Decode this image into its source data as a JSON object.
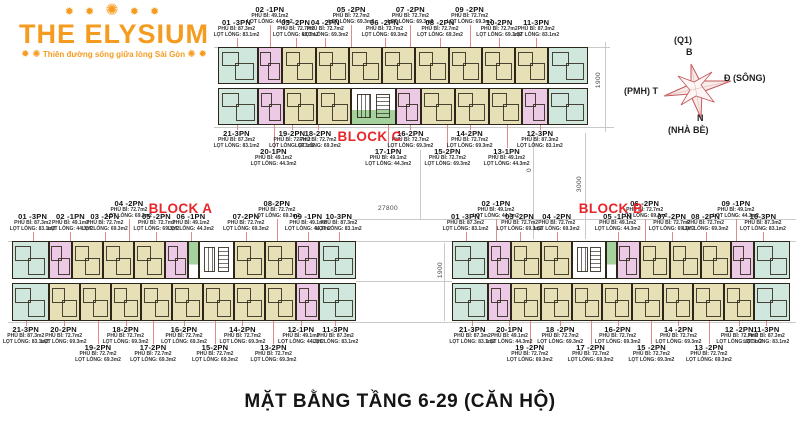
{
  "logo": {
    "stars_l": "✹ ✹",
    "star_mid": "✺",
    "stars_r": "✹ ✹",
    "title": "THE ELYSIUM",
    "tag_l": "✹ ✺",
    "tagline": "Thiên đường sống giữa lòng Sài Gòn",
    "tag_r": "✺ ✹",
    "color": "#f59b20"
  },
  "compass": {
    "q1": "(Q1)",
    "b": "B",
    "e": "Đ (SÔNG)",
    "w": "(PMH) T",
    "n": "N",
    "nb": "(NHÀ BÈ)",
    "color": "#c4565a"
  },
  "dims": {
    "d27800": "27800",
    "d1900c": "1900",
    "d1900b": "1900",
    "d0": "0",
    "d3000": "3000"
  },
  "title": "MẶT BẰNG TẦNG 6-29 (CĂN HỘ)",
  "palette": {
    "3PN": "#cfe7dd",
    "1PN": "#ecc9e5",
    "2PN": "#e7e0b6",
    "lobby": "#a5d29c",
    "wall": "#2b2619",
    "leader": "#e08a8a",
    "block_label": "#e8262a"
  },
  "areas": {
    "3PN": [
      "PHỦ BÌ: 87.3m2",
      "LỌT LÒNG: 83.1m2"
    ],
    "2PN": [
      "PHỦ BÌ: 72.7m2",
      "LỌT LÒNG: 69.3m2"
    ],
    "1PN": [
      "PHỦ BÌ: 49.1m2",
      "LỌT LÒNG: 44.3m2"
    ]
  },
  "blocks": [
    {
      "id": "c",
      "name": "BLOCK C",
      "geom": {
        "left": 218,
        "top": 6,
        "width": 370,
        "top_zone": 41,
        "strip_h": 37,
        "gap": 4,
        "bottom_zone": 64
      },
      "block_label": {
        "zone": "bottom",
        "x": 41
      },
      "units_top": [
        "3PN",
        "1PN",
        "2PN",
        "2PN",
        "2PN",
        "2PN",
        "2PN",
        "2PN",
        "2PN",
        "2PN",
        "3PN"
      ],
      "units_bottom": [
        "3PN",
        "1PN",
        "2PN",
        "2PN",
        "coreB",
        "1PN",
        "2PN",
        "2PN",
        "2PN",
        "1PN",
        "3PN"
      ],
      "labels_top": [
        {
          "id": "01 -3PN",
          "t": "3PN",
          "x": 5,
          "row": 2
        },
        {
          "id": "02 -1PN",
          "t": "1PN",
          "x": 14,
          "row": 1
        },
        {
          "id": "03 -2PN",
          "t": "2PN",
          "x": 21,
          "row": 2
        },
        {
          "id": "04 -2PN",
          "t": "2PN",
          "x": 29,
          "row": 2
        },
        {
          "id": "05 -2PN",
          "t": "2PN",
          "x": 36,
          "row": 1
        },
        {
          "id": "06 -2PN",
          "t": "2PN",
          "x": 45,
          "row": 2
        },
        {
          "id": "07 -2PN",
          "t": "2PN",
          "x": 52,
          "row": 1
        },
        {
          "id": "08 -2PN",
          "t": "2PN",
          "x": 60,
          "row": 2
        },
        {
          "id": "09 -2PN",
          "t": "2PN",
          "x": 68,
          "row": 1
        },
        {
          "id": "10-2PN",
          "t": "2PN",
          "x": 76,
          "row": 2
        },
        {
          "id": "11-3PN",
          "t": "3PN",
          "x": 86,
          "row": 2
        }
      ],
      "labels_bottom": [
        {
          "id": "21-3PN",
          "t": "3PN",
          "x": 5,
          "row": 1
        },
        {
          "id": "20-1PN",
          "t": "1PN",
          "x": 15,
          "row": 2
        },
        {
          "id": "19-2PN",
          "t": "2PN",
          "x": 20,
          "row": 1
        },
        {
          "id": "18-2PN",
          "t": "2PN",
          "x": 27,
          "row": 1
        },
        {
          "id": "17-1PN",
          "t": "1PN",
          "x": 46,
          "row": 2
        },
        {
          "id": "16-2PN",
          "t": "2PN",
          "x": 52,
          "row": 1
        },
        {
          "id": "15-2PN",
          "t": "2PN",
          "x": 62,
          "row": 2
        },
        {
          "id": "14-2PN",
          "t": "2PN",
          "x": 68,
          "row": 1
        },
        {
          "id": "13-1PN",
          "t": "1PN",
          "x": 78,
          "row": 2
        },
        {
          "id": "12-3PN",
          "t": "3PN",
          "x": 87,
          "row": 1
        }
      ]
    },
    {
      "id": "a",
      "name": "BLOCK A",
      "geom": {
        "left": 12,
        "top": 200,
        "width": 344,
        "top_zone": 41,
        "strip_h": 38,
        "gap": 4,
        "bottom_zone": 70
      },
      "block_label": {
        "zone": "top",
        "x": 49
      },
      "units_top": [
        "3PN",
        "1PN",
        "2PN",
        "2PN",
        "2PN",
        "1PN",
        "lobby",
        "core",
        "2PN",
        "2PN",
        "1PN",
        "3PN"
      ],
      "units_bottom": [
        "3PN",
        "2PN",
        "2PN",
        "2PN",
        "2PN",
        "2PN",
        "2PN",
        "2PN",
        "2PN",
        "1PN",
        "3PN"
      ],
      "labels_top": [
        {
          "id": "01 -3PN",
          "t": "3PN",
          "x": 6,
          "row": 2
        },
        {
          "id": "02 -1PN",
          "t": "1PN",
          "x": 17,
          "row": 2
        },
        {
          "id": "03 -2PN",
          "t": "2PN",
          "x": 27,
          "row": 2
        },
        {
          "id": "04 -2PN",
          "t": "2PN",
          "x": 34,
          "row": 1
        },
        {
          "id": "05 -2PN",
          "t": "2PN",
          "x": 42,
          "row": 2
        },
        {
          "id": "06 -1PN",
          "t": "1PN",
          "x": 52,
          "row": 2
        },
        {
          "id": "07-2PN",
          "t": "2PN",
          "x": 68,
          "row": 2
        },
        {
          "id": "08-2PN",
          "t": "2PN",
          "x": 77,
          "row": 1
        },
        {
          "id": "09 -1PN",
          "t": "1PN",
          "x": 86,
          "row": 2
        },
        {
          "id": "10-3PN",
          "t": "3PN",
          "x": 95,
          "row": 2
        }
      ],
      "labels_bottom": [
        {
          "id": "21-3PN",
          "t": "3PN",
          "x": 4,
          "row": 1
        },
        {
          "id": "20-2PN",
          "t": "2PN",
          "x": 15,
          "row": 1
        },
        {
          "id": "19-2PN",
          "t": "2PN",
          "x": 25,
          "row": 2
        },
        {
          "id": "18-2PN",
          "t": "2PN",
          "x": 33,
          "row": 1
        },
        {
          "id": "17-2PN",
          "t": "2PN",
          "x": 41,
          "row": 2
        },
        {
          "id": "16-2PN",
          "t": "2PN",
          "x": 50,
          "row": 1
        },
        {
          "id": "15-2PN",
          "t": "2PN",
          "x": 59,
          "row": 2
        },
        {
          "id": "14-2PN",
          "t": "2PN",
          "x": 67,
          "row": 1
        },
        {
          "id": "13-2PN",
          "t": "2PN",
          "x": 76,
          "row": 2
        },
        {
          "id": "12-1PN",
          "t": "1PN",
          "x": 84,
          "row": 1
        },
        {
          "id": "11-3PN",
          "t": "3PN",
          "x": 94,
          "row": 1
        }
      ]
    },
    {
      "id": "b",
      "name": "BLOCK B",
      "geom": {
        "left": 452,
        "top": 200,
        "width": 338,
        "top_zone": 41,
        "strip_h": 38,
        "gap": 4,
        "bottom_zone": 70
      },
      "block_label": {
        "zone": "top",
        "x": 47
      },
      "units_top": [
        "3PN",
        "1PN",
        "2PN",
        "2PN",
        "core",
        "lobby",
        "1PN",
        "2PN",
        "2PN",
        "2PN",
        "1PN",
        "3PN"
      ],
      "units_bottom": [
        "3PN",
        "1PN",
        "2PN",
        "2PN",
        "2PN",
        "2PN",
        "2PN",
        "2PN",
        "2PN",
        "2PN",
        "3PN"
      ],
      "labels_top": [
        {
          "id": "01 -3PN",
          "t": "3PN",
          "x": 4,
          "row": 2
        },
        {
          "id": "02 -1PN",
          "t": "1PN",
          "x": 13,
          "row": 1
        },
        {
          "id": "03 -2PN",
          "t": "2PN",
          "x": 20,
          "row": 2
        },
        {
          "id": "04 -2PN",
          "t": "2PN",
          "x": 31,
          "row": 2
        },
        {
          "id": "05 -1PN",
          "t": "1PN",
          "x": 49,
          "row": 2
        },
        {
          "id": "06 -2PN",
          "t": "2PN",
          "x": 57,
          "row": 1
        },
        {
          "id": "07 -2PN",
          "t": "2PN",
          "x": 65,
          "row": 2
        },
        {
          "id": "08 -2PN",
          "t": "2PN",
          "x": 75,
          "row": 2
        },
        {
          "id": "09 -1PN",
          "t": "1PN",
          "x": 84,
          "row": 1
        },
        {
          "id": "10-3PN",
          "t": "3PN",
          "x": 92,
          "row": 2
        }
      ],
      "labels_bottom": [
        {
          "id": "21-3PN",
          "t": "3PN",
          "x": 6,
          "row": 1
        },
        {
          "id": "20-1PN",
          "t": "1PN",
          "x": 17,
          "row": 1
        },
        {
          "id": "19 -2PN",
          "t": "2PN",
          "x": 23,
          "row": 2
        },
        {
          "id": "18 -2PN",
          "t": "2PN",
          "x": 32,
          "row": 1
        },
        {
          "id": "17 -2PN",
          "t": "2PN",
          "x": 41,
          "row": 2
        },
        {
          "id": "16-2PN",
          "t": "2PN",
          "x": 49,
          "row": 1
        },
        {
          "id": "15 -2PN",
          "t": "2PN",
          "x": 59,
          "row": 2
        },
        {
          "id": "14 -2PN",
          "t": "2PN",
          "x": 67,
          "row": 1
        },
        {
          "id": "13 -2PN",
          "t": "2PN",
          "x": 76,
          "row": 2
        },
        {
          "id": "12 -2PN",
          "t": "2PN",
          "x": 85,
          "row": 1
        },
        {
          "id": "11-3PN",
          "t": "3PN",
          "x": 93,
          "row": 1
        }
      ]
    }
  ]
}
